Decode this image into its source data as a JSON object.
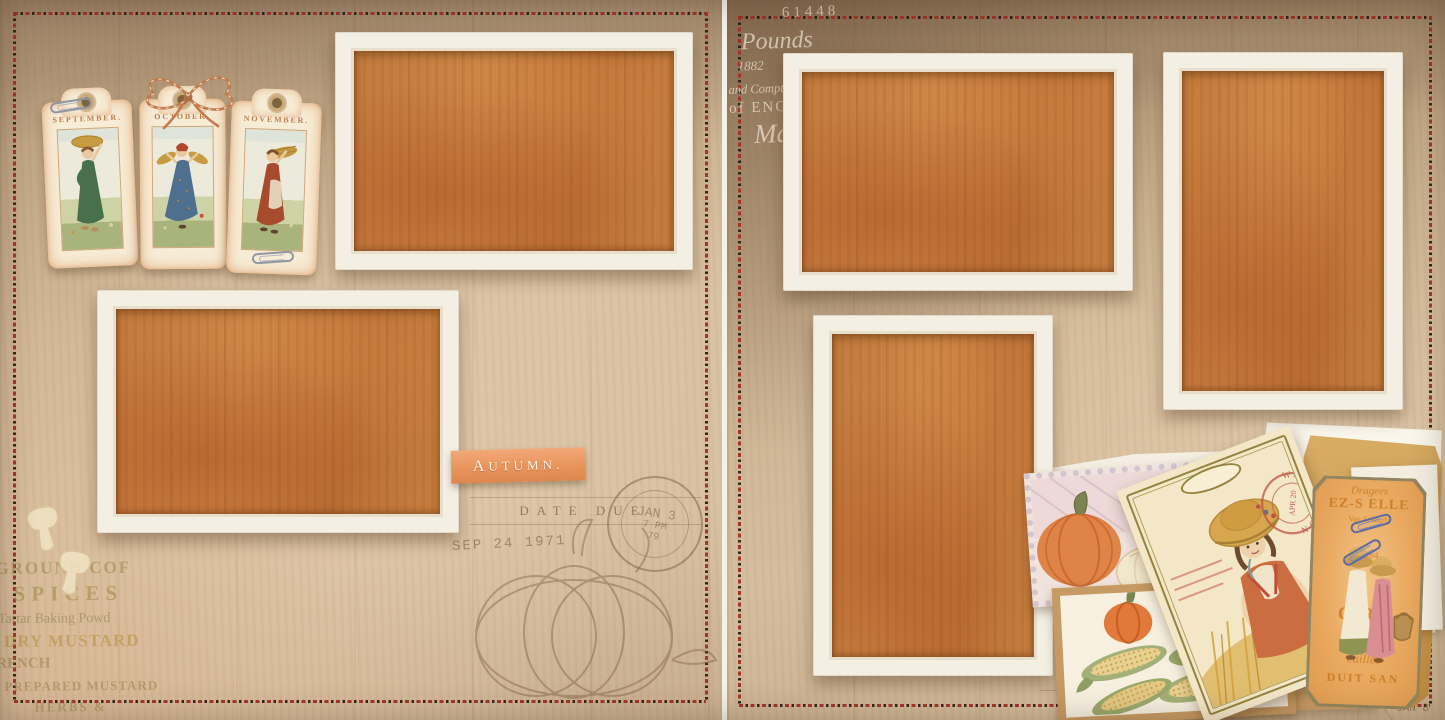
{
  "left_page": {
    "tags": [
      {
        "label": "SEPTEMBER."
      },
      {
        "label": "OCTOBER."
      },
      {
        "label": "NOVEMBER."
      }
    ],
    "autumn_label": "AUTUMN.",
    "ad_lines": [
      "GROUND COF",
      "SPICES",
      "Tartar Baking Powd",
      "DRY MUSTARD",
      "RENCH",
      "PREPARED MUSTARD",
      "HERBS &"
    ],
    "library_stamp": {
      "date_due": "DATE DUE",
      "date_stamp": "SEP 24 1971",
      "postmark_line1": "JAN 3",
      "postmark_line2": "7 PM",
      "postmark_line3": "79"
    }
  },
  "right_page": {
    "script_lines": [
      "61448",
      "Pounds",
      "1882",
      "and Comptroller of the",
      "of ENGLAND.",
      "Ma"
    ],
    "bottom_stamp": {
      "date_due": "DATE DUE",
      "postmark": "JAN 8"
    },
    "postcard": {
      "postmark_city": "WASHINGTON",
      "postmark_date": "APR 20"
    },
    "ticket_lines": [
      "Dragees",
      "EZ-S ELLE",
      "Van Schaerb",
      "No 84",
      "C RY",
      "euilles",
      "DUIT SAN"
    ]
  },
  "colors": {
    "photo_placeholder": "#c07a3d",
    "frame_white": "#f4efe3",
    "stitch_red": "#a03028",
    "background_tan": "#cdb394",
    "accent_orange": "#e8945c",
    "kraft_brown": "#c89b64"
  }
}
